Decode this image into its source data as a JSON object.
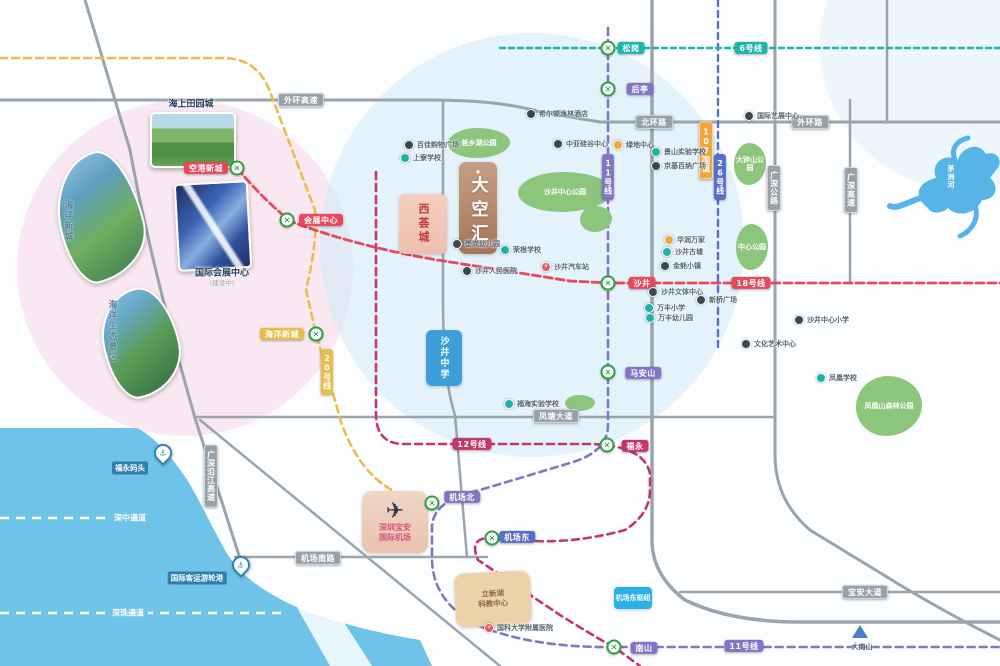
{
  "project": {
    "name": "大空汇"
  },
  "map": {
    "colors": {
      "sea": "#6fc2e8",
      "road": "#9ba3ab",
      "station_ring": "#2f9e44",
      "line_red": "#e8485c",
      "line_magenta": "#c2366b",
      "line_purple": "#8276c4",
      "line_indigo": "#5b6ec7",
      "line_yellow": "#e9bd4a",
      "line_teal": "#1ab5ab",
      "badge_gray": "#97a1aa",
      "badge_orange": "#f0a63c"
    },
    "metro_lines": [
      {
        "name": "20号线",
        "color": "#e9bd4a",
        "w": 2.6,
        "dash": "7 5",
        "d": "M0,58 H222 Q258,58 270,92 L315,210 Q318,240 306,290 L316,334 L342,425 Q362,478 400,494 L428,503"
      },
      {
        "name": "18号线",
        "color": "#e8485c",
        "w": 2.8,
        "dash": "8 4",
        "d": "M237,168 Q262,198 290,221 Q360,248 450,262 L570,281 L610,283 H1000"
      },
      {
        "name": "12号线",
        "color": "#c2366b",
        "w": 2.6,
        "dash": "7 5",
        "d": "M376,172 V414 Q376,444 404,444 H592 Q645,446 650,474 V490 Q650,514 625,530 Q570,545 520,540 L492,538 Q468,537 478,560 L560,615 Q600,640 614,647 L640,666"
      },
      {
        "name": "11号线",
        "color": "#8276c4",
        "w": 2.6,
        "dash": "7 5",
        "d": "M608,28 V425 Q608,452 570,463 L480,490 Q432,500 432,528 V558 Q432,600 475,624 Q530,648 614,647 H1000"
      },
      {
        "name": "26号线",
        "color": "#5b6ec7",
        "w": 2.4,
        "dash": "6 5",
        "d": "M718,0 V350"
      },
      {
        "name": "6号线",
        "color": "#1ab5ab",
        "w": 2.4,
        "dash": "5 4",
        "d": "M500,48 H1000"
      }
    ],
    "roads": [
      {
        "d": "M0,100 H430 Q500,100 540,112 L600,122 H1000",
        "w": 3
      },
      {
        "d": "M85,0 L130,150 Q150,260 195,418 L243,568",
        "w": 3
      },
      {
        "d": "M200,420 L500,666",
        "w": 2.5
      },
      {
        "d": "M196,417 H775",
        "w": 2.5
      },
      {
        "d": "M235,557 H487",
        "w": 2.5
      },
      {
        "d": "M443,100 V300 Q443,380 455,415 L467,557",
        "w": 2.5
      },
      {
        "d": "M652,0 V540 Q652,575 685,600 Q730,622 800,622 H1000",
        "w": 3.5
      },
      {
        "d": "M775,0 V455 Q775,500 810,530 L900,585 Q950,615 1000,640",
        "w": 3
      },
      {
        "d": "M850,100 V283",
        "w": 2.5
      },
      {
        "d": "M887,0 V122",
        "w": 2.5
      },
      {
        "d": "M680,592 H1000",
        "w": 2.5
      }
    ],
    "tunnels": [
      {
        "label": "深中通道",
        "d": "M0,518 H150",
        "lx": 130,
        "ly": 518
      },
      {
        "label": "深珠通道",
        "d": "M0,613 H282",
        "lx": 128,
        "ly": 613
      }
    ],
    "stations": [
      {
        "name": "空港新城",
        "x": 237,
        "y": 168,
        "color": "red",
        "bx": 206,
        "by": 168
      },
      {
        "name": "会展中心",
        "x": 287,
        "y": 220,
        "color": "red",
        "bx": 321,
        "by": 220
      },
      {
        "name": "海洋新城",
        "x": 316,
        "y": 334,
        "color": "yellow",
        "bx": 282,
        "by": 334
      },
      {
        "name": "松岗",
        "x": 608,
        "y": 48,
        "color": "teal",
        "bx": 631,
        "by": 48
      },
      {
        "name": "后亭",
        "x": 608,
        "y": 89,
        "color": "purple",
        "bx": 640,
        "by": 89
      },
      {
        "name": "沙井",
        "x": 608,
        "y": 283,
        "color": "red",
        "bx": 642,
        "by": 283
      },
      {
        "name": "马安山",
        "x": 608,
        "y": 372,
        "color": "purple",
        "bx": 643,
        "by": 373
      },
      {
        "name": "福永",
        "x": 607,
        "y": 445,
        "color": "magenta",
        "bx": 635,
        "by": 446
      },
      {
        "name": "机场北",
        "x": 432,
        "y": 503,
        "color": "purple",
        "bx": 462,
        "by": 497
      },
      {
        "name": "机场东",
        "x": 492,
        "y": 538,
        "color": "indigo",
        "bx": 517,
        "by": 537
      },
      {
        "name": "南山",
        "x": 614,
        "y": 647,
        "color": "purple",
        "bx": 644,
        "by": 648
      }
    ],
    "line_badges": [
      {
        "text": "6号线",
        "color": "teal",
        "x": 751,
        "y": 48
      },
      {
        "text": "18号线",
        "color": "red",
        "x": 751,
        "y": 283
      },
      {
        "text": "12号线",
        "color": "magenta",
        "x": 472,
        "y": 444
      },
      {
        "text": "11号线",
        "color": "purple",
        "x": 608,
        "y": 177,
        "vertical": true
      },
      {
        "text": "26号线",
        "color": "indigo",
        "x": 720,
        "y": 177,
        "vertical": true
      },
      {
        "text": "20号线",
        "color": "yellow",
        "x": 327,
        "y": 372,
        "vertical": true
      },
      {
        "text": "11号线",
        "color": "purple",
        "x": 744,
        "y": 646
      }
    ],
    "road_badges": [
      {
        "text": "外环高速",
        "x": 301,
        "y": 100
      },
      {
        "text": "北环路",
        "x": 654,
        "y": 122
      },
      {
        "text": "外环路",
        "x": 810,
        "y": 122
      },
      {
        "text": "凤塘大道",
        "x": 556,
        "y": 416
      },
      {
        "text": "机场南路",
        "x": 318,
        "y": 558
      },
      {
        "text": "宝安大道",
        "x": 865,
        "y": 592
      },
      {
        "text": "107国道",
        "x": 706,
        "y": 150,
        "vertical": true,
        "orange": true
      },
      {
        "text": "广深公路",
        "x": 774,
        "y": 188,
        "vertical": true
      },
      {
        "text": "广深高速",
        "x": 851,
        "y": 190,
        "vertical": true
      },
      {
        "text": "广深沿江高速",
        "x": 211,
        "y": 476,
        "vertical": true
      }
    ],
    "pois": [
      {
        "label": "希尔顿逸林酒店",
        "x": 530,
        "y": 114,
        "type": "black"
      },
      {
        "label": "中亚硅谷中心",
        "x": 557,
        "y": 144,
        "type": "black"
      },
      {
        "label": "绿地中心",
        "x": 617,
        "y": 145,
        "type": "orange"
      },
      {
        "label": "景山实验学校",
        "x": 655,
        "y": 152,
        "type": "teal"
      },
      {
        "label": "京基百纳广场",
        "x": 655,
        "y": 166,
        "type": "black"
      },
      {
        "label": "国际艺展中心",
        "x": 748,
        "y": 116,
        "type": "black"
      },
      {
        "label": "百佳购物广场",
        "x": 408,
        "y": 145,
        "type": "black"
      },
      {
        "label": "上寮学校",
        "x": 404,
        "y": 158,
        "type": "teal"
      },
      {
        "label": "壆岗幼儿园",
        "x": 456,
        "y": 244,
        "type": "black"
      },
      {
        "label": "荣根学校",
        "x": 504,
        "y": 250,
        "type": "teal"
      },
      {
        "label": "沙井人民医院",
        "x": 466,
        "y": 271,
        "type": "black"
      },
      {
        "label": "沙井汽车站",
        "x": 545,
        "y": 267,
        "type": "red"
      },
      {
        "label": "华润万家",
        "x": 668,
        "y": 240,
        "type": "orange"
      },
      {
        "label": "沙井古墟",
        "x": 666,
        "y": 252,
        "type": "teal"
      },
      {
        "label": "金蚝小镇",
        "x": 664,
        "y": 266,
        "type": "black"
      },
      {
        "label": "沙井文体中心",
        "x": 652,
        "y": 292,
        "type": "black"
      },
      {
        "label": "万丰小学",
        "x": 648,
        "y": 308,
        "type": "teal"
      },
      {
        "label": "万丰幼儿园",
        "x": 649,
        "y": 318,
        "type": "teal"
      },
      {
        "label": "新桥广场",
        "x": 700,
        "y": 300,
        "type": "black"
      },
      {
        "label": "沙井中心小学",
        "x": 798,
        "y": 320,
        "type": "black"
      },
      {
        "label": "文化艺术中心",
        "x": 745,
        "y": 344,
        "type": "black"
      },
      {
        "label": "凤凰学校",
        "x": 820,
        "y": 378,
        "type": "teal"
      },
      {
        "label": "福海实验学校",
        "x": 508,
        "y": 404,
        "type": "teal"
      },
      {
        "label": "国科大学附属医院",
        "x": 488,
        "y": 628,
        "type": "red"
      }
    ],
    "parks": [
      {
        "label": "蚝乡湖公园",
        "x": 448,
        "y": 128,
        "w": 62,
        "h": 30
      },
      {
        "label": "沙井中心公园",
        "x": 518,
        "y": 172,
        "w": 94,
        "h": 40
      },
      {
        "label": "",
        "x": 580,
        "y": 206,
        "w": 32,
        "h": 26
      },
      {
        "label": "大钟山公园",
        "x": 734,
        "y": 143,
        "w": 32,
        "h": 42
      },
      {
        "label": "中心公园",
        "x": 736,
        "y": 224,
        "w": 32,
        "h": 46
      },
      {
        "label": "凤凰山森林公园",
        "x": 856,
        "y": 376,
        "w": 66,
        "h": 60
      },
      {
        "label": "",
        "x": 565,
        "y": 395,
        "w": 30,
        "h": 16
      }
    ],
    "blocks": [
      {
        "cls": "b-xihui",
        "lines": [
          "西荟城"
        ],
        "x": 399,
        "y": 194,
        "w": 48,
        "h": 60
      },
      {
        "cls": "b-school",
        "lines": [
          "沙井中学"
        ],
        "x": 426,
        "y": 330,
        "w": 36,
        "h": 56
      },
      {
        "cls": "b-airport",
        "lines": [
          "深圳宝安",
          "国际机场"
        ],
        "x": 362,
        "y": 491,
        "w": 66,
        "h": 62
      },
      {
        "cls": "b-campus",
        "lines": [
          "立新湖",
          "科教中心"
        ],
        "x": 455,
        "y": 572,
        "w": 76,
        "h": 54
      },
      {
        "cls": "b-hub",
        "lines": [
          "机场东枢纽"
        ],
        "x": 614,
        "y": 587,
        "w": 38,
        "h": 22
      }
    ],
    "logo": {
      "text": "大空汇",
      "x": 459,
      "y": 162,
      "w": 38,
      "h": 92
    },
    "images": [
      {
        "cls": "card card1",
        "x": 150,
        "y": 112,
        "w": 82,
        "h": 52,
        "caption": "海上田园城",
        "cap_x": 191,
        "cap_y": 103,
        "cap_vertical": false
      },
      {
        "cls": "card card2",
        "x": 176,
        "y": 182,
        "w": 70,
        "h": 84,
        "caption": "国际会展中心",
        "cap_x": 222,
        "cap_y": 272,
        "cap_vertical": false,
        "sub": "(建设中)",
        "sub_x": 222,
        "sub_y": 282
      },
      {
        "cls": "leaf leaf1",
        "x": 58,
        "y": 152,
        "w": 80,
        "h": 125,
        "caption": "海洋新城",
        "cap_x": 62,
        "cap_y": 200,
        "cap_vertical": true
      },
      {
        "cls": "leaf leaf2",
        "x": 103,
        "y": 288,
        "w": 72,
        "h": 105,
        "caption": "海洋生态景区",
        "cap_x": 106,
        "cap_y": 300,
        "cap_vertical": true
      }
    ],
    "markers": [
      {
        "label": "福永码头",
        "px": 163,
        "py": 462,
        "lx": 130,
        "ly": 468
      },
      {
        "label": "国际客运游轮港",
        "px": 241,
        "py": 574,
        "lx": 197,
        "ly": 578
      }
    ],
    "mountain": {
      "label": "大南山",
      "x": 860,
      "y": 638,
      "lx": 862,
      "ly": 642
    },
    "river": {
      "label": "茅洲河",
      "x": 946,
      "y": 165
    }
  }
}
